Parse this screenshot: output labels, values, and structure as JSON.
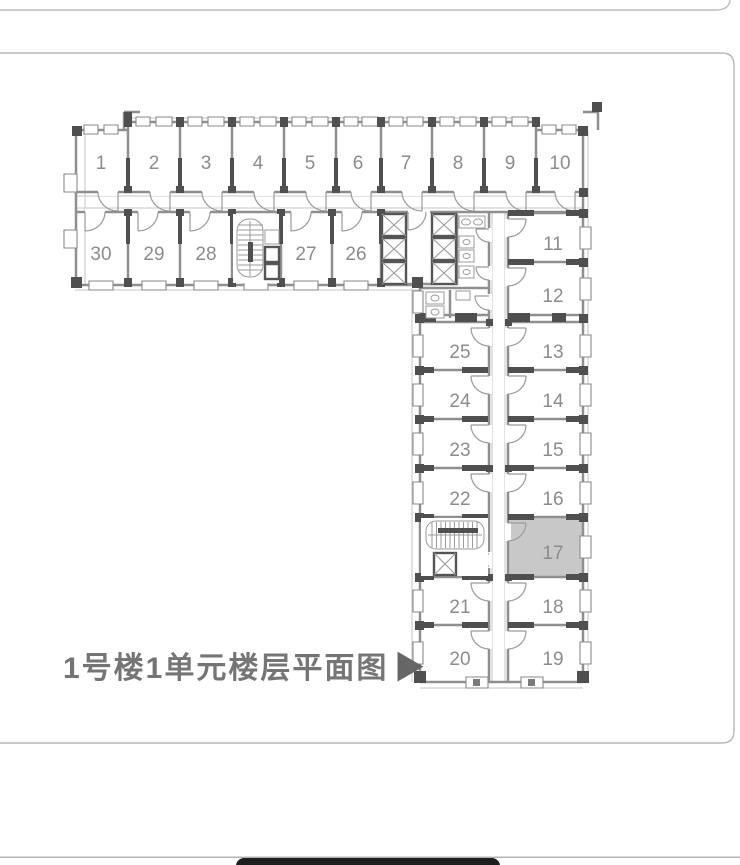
{
  "plan": {
    "title": "1号楼1单元楼层平面图",
    "title_arrow": "▶",
    "highlighted_room": "17",
    "highlight_color": "#c8c8c8",
    "rooms": [
      "1",
      "2",
      "3",
      "4",
      "5",
      "6",
      "7",
      "8",
      "9",
      "10",
      "11",
      "12",
      "13",
      "14",
      "15",
      "16",
      "17",
      "18",
      "19",
      "20",
      "21",
      "22",
      "23",
      "24",
      "25",
      "26",
      "27",
      "28",
      "29",
      "30"
    ]
  },
  "colors": {
    "wall": "#8f8f8f",
    "column": "#4f4f4f",
    "room_label": "#8c8c8c",
    "title": "#757575",
    "card_border": "#b7b7b7",
    "bottom_hairline": "#b3b3b3",
    "home_indicator": "#1e1e1e"
  }
}
